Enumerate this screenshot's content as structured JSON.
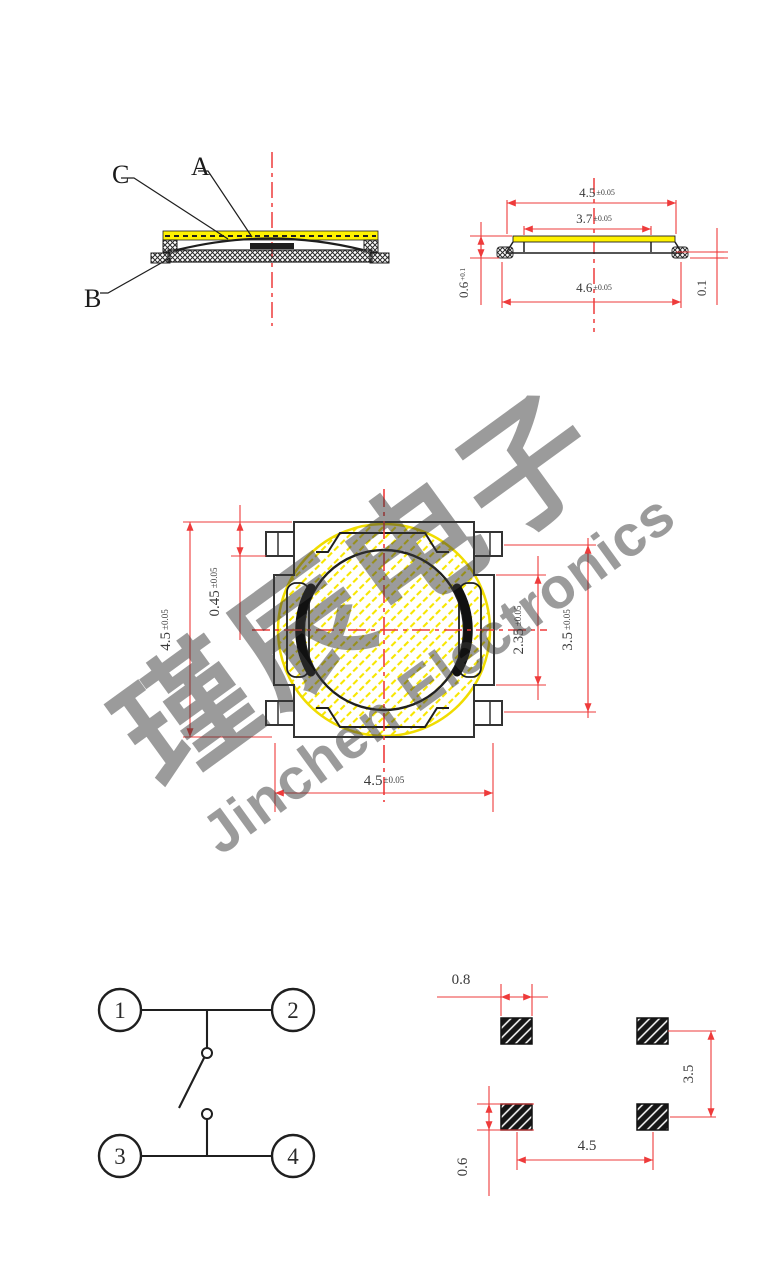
{
  "drawing": {
    "section_view": {
      "label_a": "A",
      "label_b": "B",
      "label_c": "C"
    },
    "side_view": {
      "top_width": {
        "value": "4.5",
        "tol": "±0.05"
      },
      "inner_width": {
        "value": "3.7",
        "tol": "±0.05"
      },
      "bottom_width": {
        "value": "4.6",
        "tol": "±0.05"
      },
      "height": {
        "value": "0.6",
        "tol": "+0.1"
      },
      "foot_thickness": {
        "value": "0.1",
        "tol": ""
      }
    },
    "top_view": {
      "body_height": {
        "value": "4.5",
        "tol": "±0.05"
      },
      "pin_inset": {
        "value": "0.45",
        "tol": "±0.05"
      },
      "step_height": {
        "value": "2.35",
        "tol": "±0.05"
      },
      "pin_pitch": {
        "value": "3.5",
        "tol": "±0.05"
      },
      "body_width": {
        "value": "4.5",
        "tol": "±0.05"
      }
    },
    "schematic": {
      "pin1": "1",
      "pin2": "2",
      "pin3": "3",
      "pin4": "4"
    },
    "land_pattern": {
      "pad_width": "0.8",
      "vertical_pitch": "3.5",
      "horizontal_pitch": "4.5",
      "pad_height": "0.6"
    }
  },
  "watermark": {
    "chinese": "瑾辰电子",
    "english": "Jinchen Electronics"
  }
}
